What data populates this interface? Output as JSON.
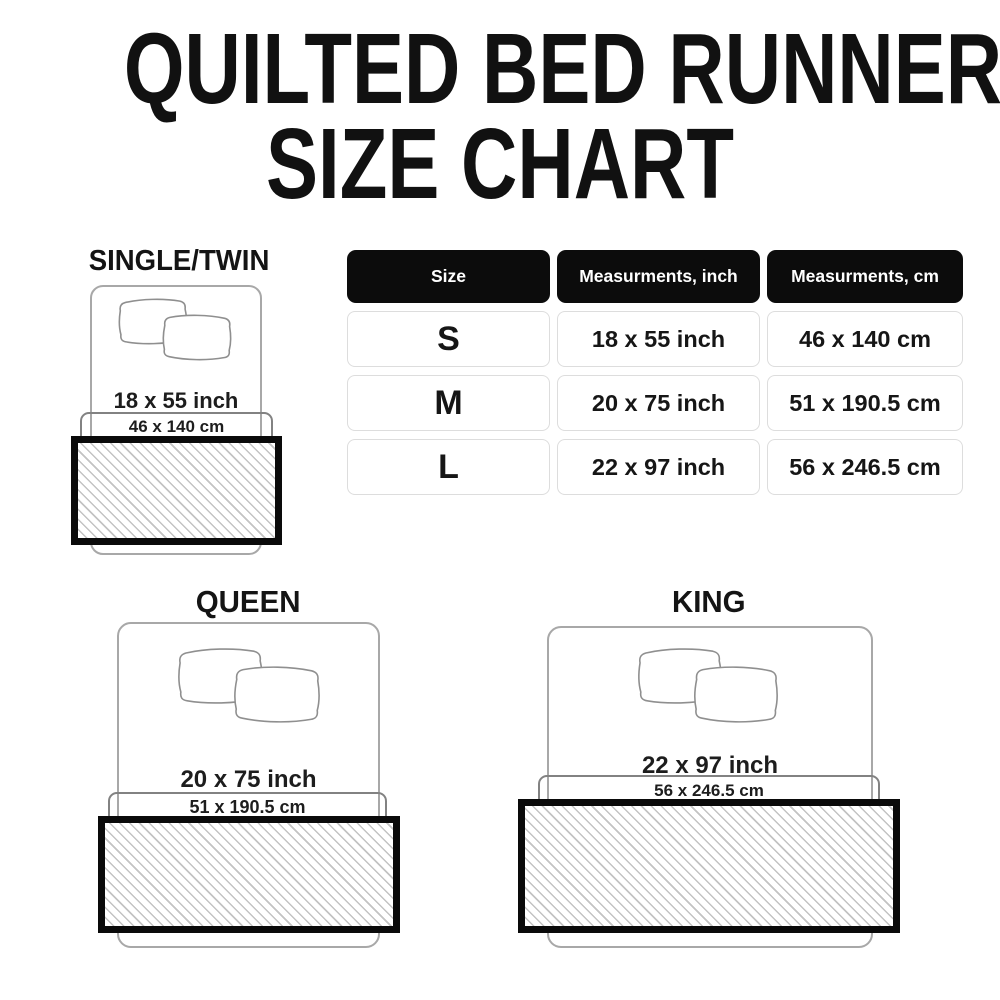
{
  "title": {
    "line1": "QUILTED BED RUNNER",
    "line2": "SIZE CHART"
  },
  "size_table": {
    "headers": [
      "Size",
      "Measurments, inch",
      "Measurments, cm"
    ],
    "rows": [
      {
        "size": "S",
        "inch": "18 x 55 inch",
        "cm": "46 x 140 cm"
      },
      {
        "size": "M",
        "inch": "20 x 75 inch",
        "cm": "51 x 190.5 cm"
      },
      {
        "size": "L",
        "inch": "22 x 97 inch",
        "cm": "56 x 246.5 cm"
      }
    ]
  },
  "diagrams": [
    {
      "label": "SINGLE/TWIN",
      "inch_label": "18 x 55 inch",
      "cm_label": "46 x 140 cm"
    },
    {
      "label": "QUEEN",
      "inch_label": "20 x 75 inch",
      "cm_label": "51 x 190.5 cm"
    },
    {
      "label": "KING",
      "inch_label": "22 x 97 inch",
      "cm_label": "56 x 246.5 cm"
    }
  ],
  "colors": {
    "background": "#ffffff",
    "title_text": "#111111",
    "table_header_bg": "#0c0c0c",
    "table_header_text": "#ffffff",
    "table_cell_border": "#dddddd",
    "body_text": "#161616",
    "bed_outline": "#a8a8a8",
    "pillow_outline": "#8f8f8f",
    "bracket_outline": "#828282",
    "runner_border": "#0a0a0a",
    "hatch_line": "#c3c3c3"
  }
}
